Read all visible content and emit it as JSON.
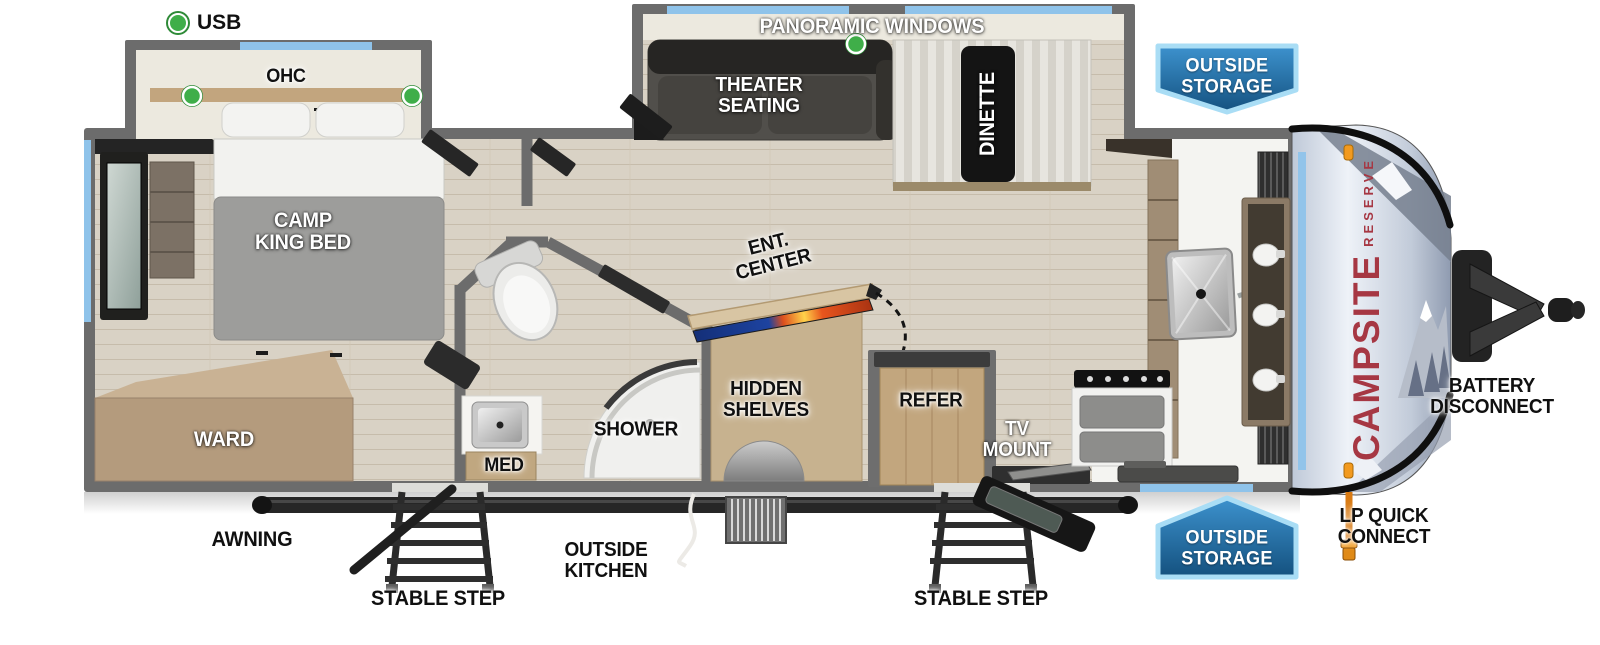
{
  "legend": {
    "usb": "USB"
  },
  "logo": {
    "primary": "CAMPSITE",
    "secondary": "RESERVE"
  },
  "badges": {
    "outside_storage_top": "OUTSIDE\nSTORAGE",
    "outside_storage_bottom": "OUTSIDE\nSTORAGE"
  },
  "labels": {
    "ohc": "OHC",
    "panoramic_windows": "PANORAMIC WINDOWS",
    "theater_seating": "THEATER\nSEATING",
    "dinette": "DINETTE",
    "camp_king_bed": "CAMP\nKING BED",
    "ward": "WARD",
    "ent_center": "ENT.\nCENTER",
    "hidden_shelves": "HIDDEN\nSHELVES",
    "med": "MED",
    "shower": "SHOWER",
    "refer": "REFER",
    "tv_mount": "TV\nMOUNT",
    "awning": "AWNING",
    "stable_step_left": "STABLE STEP",
    "stable_step_right": "STABLE STEP",
    "outside_kitchen": "OUTSIDE\nKITCHEN",
    "battery_disconnect": "BATTERY\nDISCONNECT",
    "lp_quick_connect": "LP QUICK\nCONNECT"
  },
  "colors": {
    "usb_green": "#3fae49",
    "window_blue": "#8fc3ea",
    "badge_blue_light": "#3d92ce",
    "badge_blue_dark": "#14517f",
    "badge_border": "#a9ddf5",
    "logo_red": "#a63743",
    "wall_gray": "#6c6c6c",
    "floor_tan": "#d9d2c6"
  }
}
